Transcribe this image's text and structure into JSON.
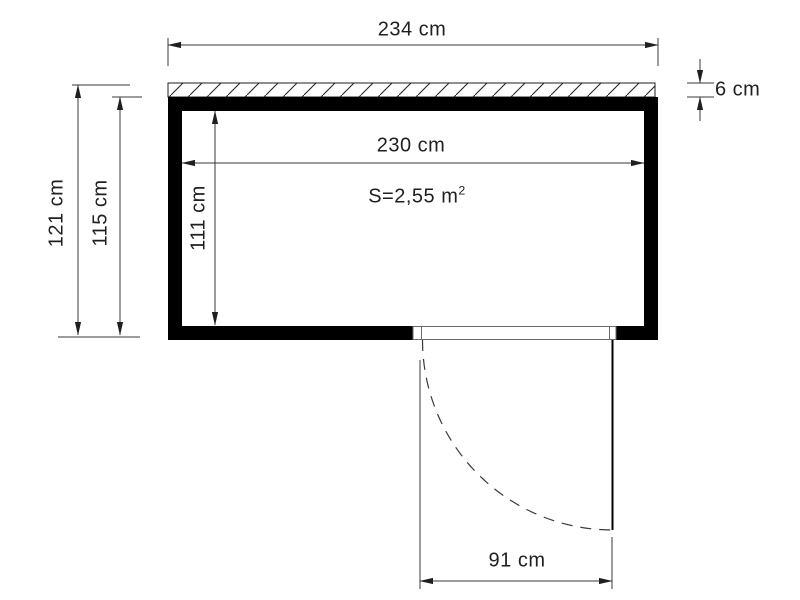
{
  "colors": {
    "wall": "#000000",
    "line": "#3a3a3a",
    "text": "#1f1f1f",
    "background": "#ffffff"
  },
  "floor_plan": {
    "type": "shed-top-view-floor-plan",
    "dimensions": {
      "outer_width": {
        "label": "234 cm",
        "value": 234,
        "unit": "cm"
      },
      "inner_width": {
        "label": "230 cm",
        "value": 230,
        "unit": "cm"
      },
      "outer_depth": {
        "label": "121 cm",
        "value": 121,
        "unit": "cm"
      },
      "body_depth": {
        "label": "115 cm",
        "value": 115,
        "unit": "cm"
      },
      "inner_depth": {
        "label": "111 cm",
        "value": 111,
        "unit": "cm"
      },
      "roof_overhang": {
        "label": "6 cm",
        "value": 6,
        "unit": "cm"
      },
      "door_width": {
        "label": "91 cm",
        "value": 91,
        "unit": "cm"
      }
    },
    "area": {
      "prefix": "S=2,55 m",
      "sup": "2",
      "value": 2.55,
      "unit": "m2"
    }
  }
}
